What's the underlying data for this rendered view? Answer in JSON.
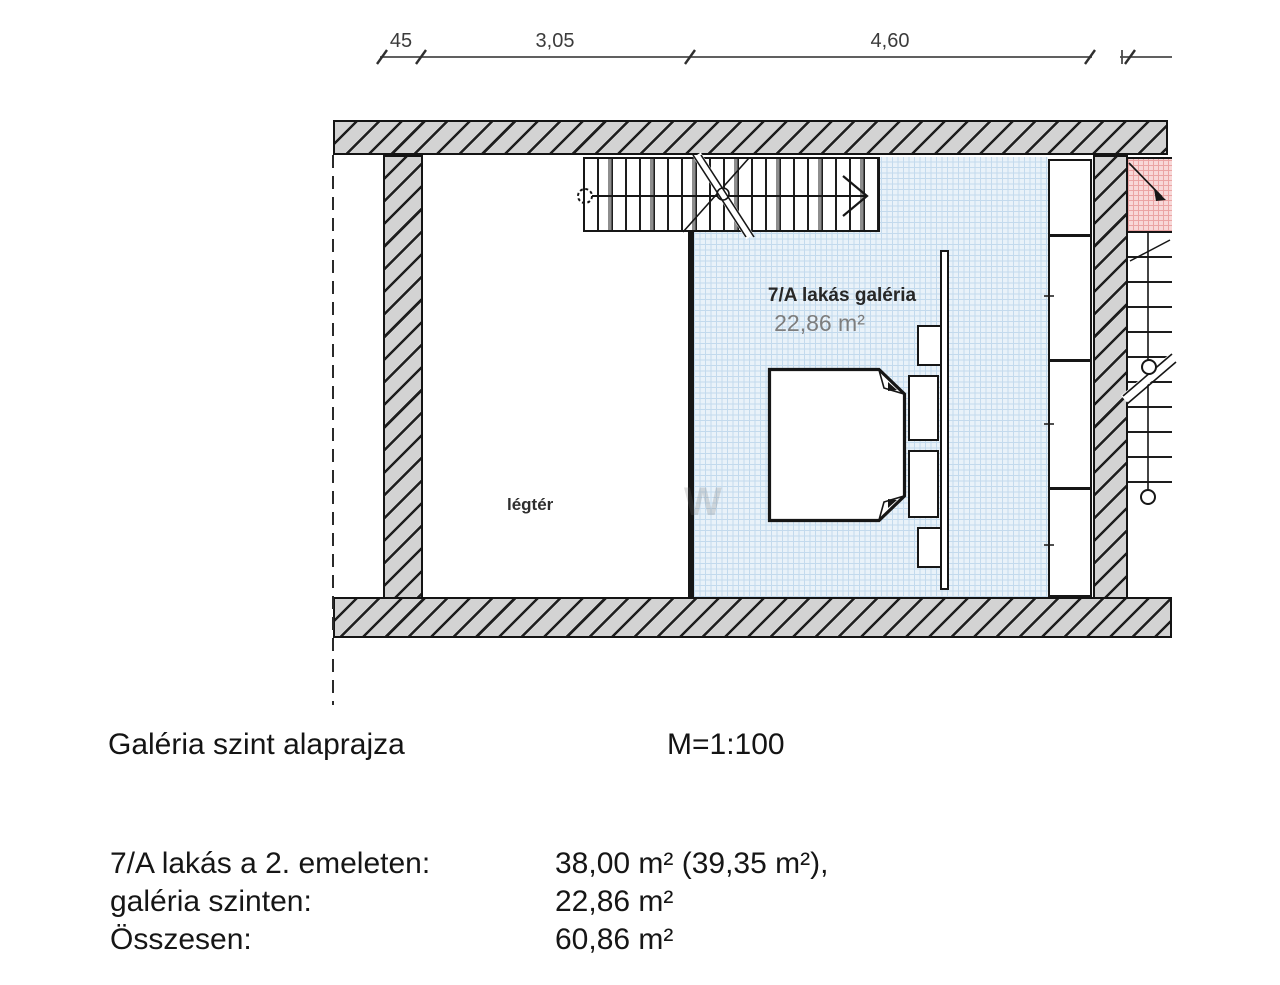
{
  "dimension_row": {
    "seg1": "45",
    "seg2": "3,05",
    "seg3": "4,60"
  },
  "plan_labels": {
    "gallery_name": "7/A lakás galéria",
    "gallery_area": "22,86 m²",
    "void": "légtér"
  },
  "caption": {
    "title": "Galéria szint alaprajza",
    "scale": "M=1:100"
  },
  "area_summary": {
    "rows": [
      {
        "label": "7/A lakás a 2. emeleten:",
        "value": "38,00 m² (39,35 m²),"
      },
      {
        "label": "galéria szinten:",
        "value": "22,86 m²"
      },
      {
        "label": "Összesen:",
        "value": "60,86 m²"
      }
    ]
  },
  "colors": {
    "wall_fill": "#d3d3d3",
    "hatch_line": "#1e1e1e",
    "gallery_fill": "#e9f2f9",
    "gallery_grid": "#c3daed",
    "stair_landing_fill": "#f8d8d8",
    "stair_landing_grid": "#eba4a4",
    "line_black": "#161616",
    "area_text_gray": "#7d7d7d"
  }
}
